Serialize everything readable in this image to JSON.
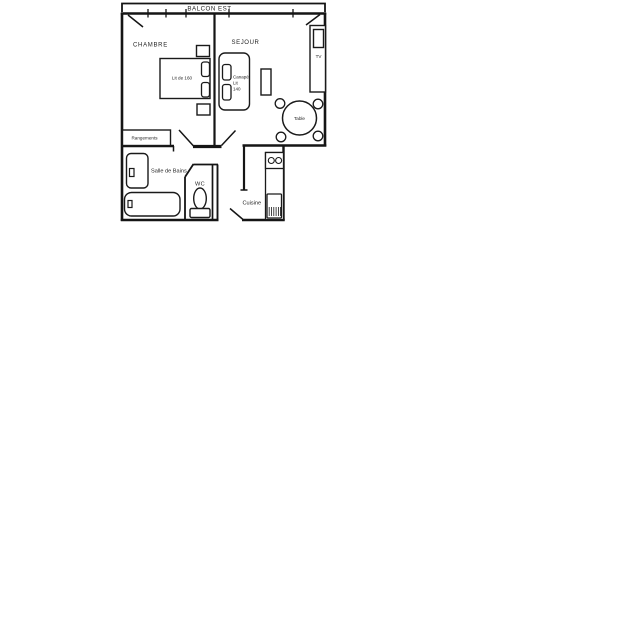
{
  "canvas": {
    "background": "#ffffff",
    "ink": "#1a1a1a"
  },
  "plan": {
    "balcony_label": "BALCON EST",
    "room_labels": {
      "chambre": "CHAMBRE",
      "sejour": "SEJOUR",
      "salle_de_bains": "Salle de Bains",
      "wc": "WC",
      "cuisine": "Cuisine"
    },
    "item_labels": {
      "bed": "Lit de 160",
      "sofa_line1": "Canapé",
      "sofa_line2": "Lit",
      "sofa_line3": "140",
      "tv": "TV",
      "table": "Table",
      "storage": "Rangements"
    }
  }
}
